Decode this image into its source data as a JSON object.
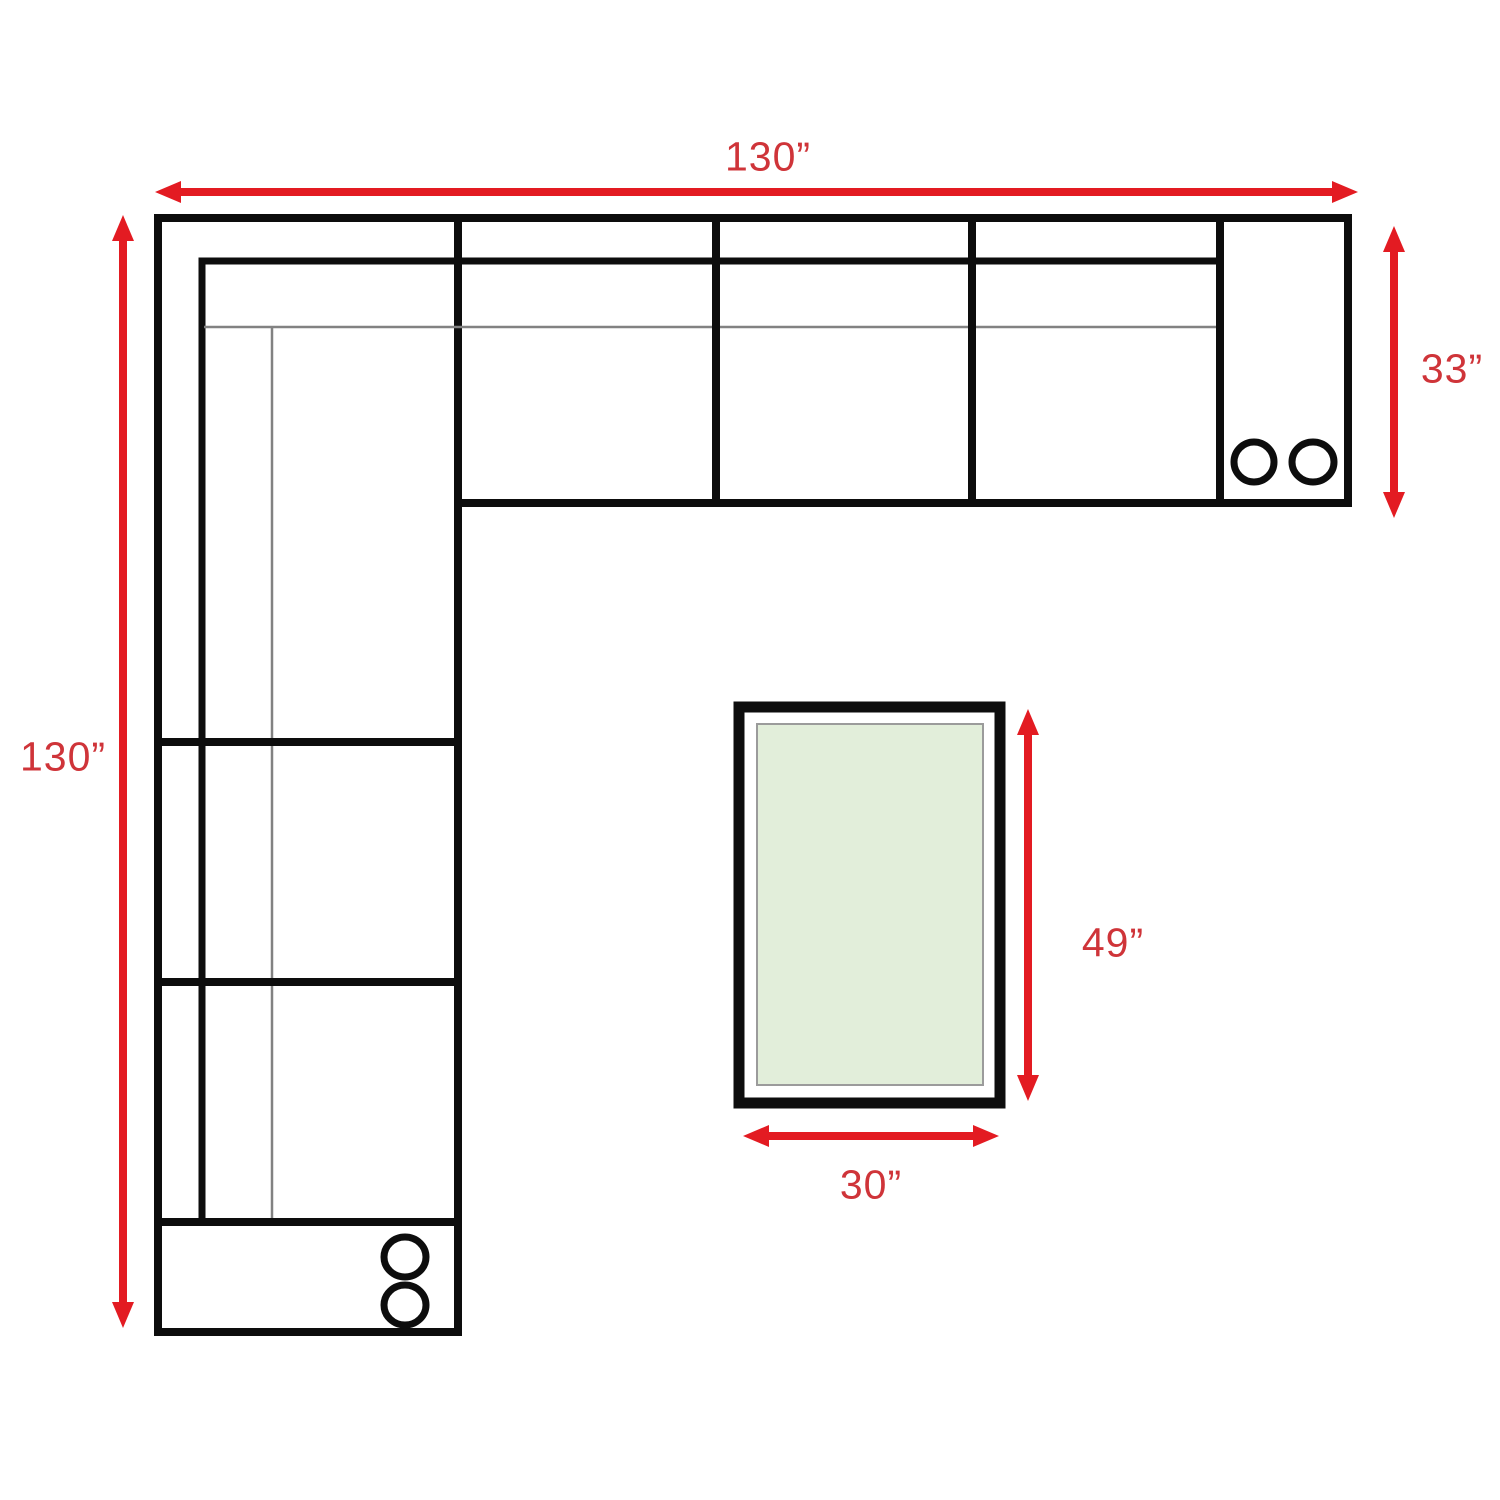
{
  "diagram": {
    "type": "sectional-sofa-floor-plan-with-ottoman",
    "labels": {
      "sofa_width": "130”",
      "sofa_height": "130”",
      "sofa_depth": "33”",
      "table_length": "49”",
      "table_width": "30”"
    },
    "colors": {
      "arrow_red": "#e31b22",
      "label_red": "#cf3439",
      "outline_black": "#0d0d0d",
      "thin_gray": "#828282",
      "table_fill_green": "#e2eeda",
      "table_inner_border": "#9b9b9b",
      "page_bg": "#ffffff"
    }
  }
}
